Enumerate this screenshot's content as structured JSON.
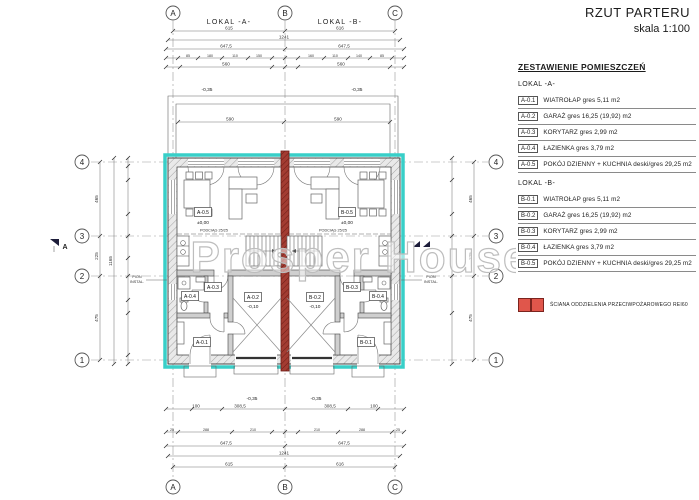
{
  "title": {
    "main": "RZUT PARTERU",
    "scale": "skala 1:100"
  },
  "watermark": "Prosper House",
  "colors": {
    "wall_highlight": "#38cfc8",
    "fire_wall": "#a33c32",
    "fire_legend": "#e0564b"
  },
  "legend": {
    "heading": "ZESTAWIENIE POMIESZCZEŃ",
    "lokal_a": "LOKAL -A-",
    "lokal_b": "LOKAL -B-",
    "rooms_a": [
      {
        "code": "A-0.1",
        "desc": "WIATROŁAP gres 5,11 m2"
      },
      {
        "code": "A-0.2",
        "desc": "GARAŻ gres 16,25 (19,92) m2"
      },
      {
        "code": "A-0.3",
        "desc": "KORYTARZ gres 2,99 m2"
      },
      {
        "code": "A-0.4",
        "desc": "ŁAZIENKA gres 3,79 m2"
      },
      {
        "code": "A-0.5",
        "desc": "POKÓJ  DZIENNY + KUCHNIA deski/gres 29,25 m2"
      }
    ],
    "rooms_b": [
      {
        "code": "B-0.1",
        "desc": "WIATROŁAP gres 5,11 m2"
      },
      {
        "code": "B-0.2",
        "desc": "GARAŻ gres 16,25 (19,92) m2"
      },
      {
        "code": "B-0.3",
        "desc": "KORYTARZ gres 2,99 m2"
      },
      {
        "code": "B-0.4",
        "desc": "ŁAZIENKA gres 3,79 m2"
      },
      {
        "code": "B-0.5",
        "desc": "POKÓJ  DZIENNY + KUCHNIA deski/gres 29,25 m2"
      }
    ],
    "fire_note": "ŚCIANA ODDZIELENIA PRZECIWPOŻAROWEGO REI60"
  },
  "plan": {
    "unit_a": "LOKAL -A-",
    "unit_b": "LOKAL -B-",
    "axes_letters": [
      "A",
      "B",
      "C"
    ],
    "axes_numbers": [
      "1",
      "2",
      "3",
      "4"
    ],
    "codes": {
      "a1": "A-0.1",
      "a2": "A-0.2",
      "a3": "A-0.3",
      "a4": "A-0.4",
      "a5": "A-0.5",
      "b1": "B-0.1",
      "b2": "B-0.2",
      "b3": "B-0.3",
      "b4": "B-0.4",
      "b5": "B-0.5"
    },
    "levels": {
      "terrace": "-0,35",
      "garage": "-0,10",
      "floor": "±0,00"
    },
    "beam": "PODCIĄG 25/25",
    "riser_line1": "PION",
    "riser_line2": "INSTAL.",
    "section": "A",
    "dims": {
      "top_615": "615",
      "top_616": "616",
      "top_1241": "1241",
      "top_647": "647,5",
      "top_small": [
        "85",
        "180",
        "110",
        "150",
        "160",
        "110",
        "140",
        "85"
      ],
      "top_560": "560",
      "terrace_590": "590",
      "left": [
        "465",
        "225",
        "475"
      ],
      "left_total": "1165",
      "bottom_100": "100",
      "bottom_308": "308,5",
      "bottom_small": [
        "25",
        "288",
        "210",
        "210",
        "288",
        "25"
      ],
      "bottom_647": "647,5",
      "bottom_1241": "1241",
      "bottom_615": "615",
      "bottom_616": "616"
    }
  }
}
